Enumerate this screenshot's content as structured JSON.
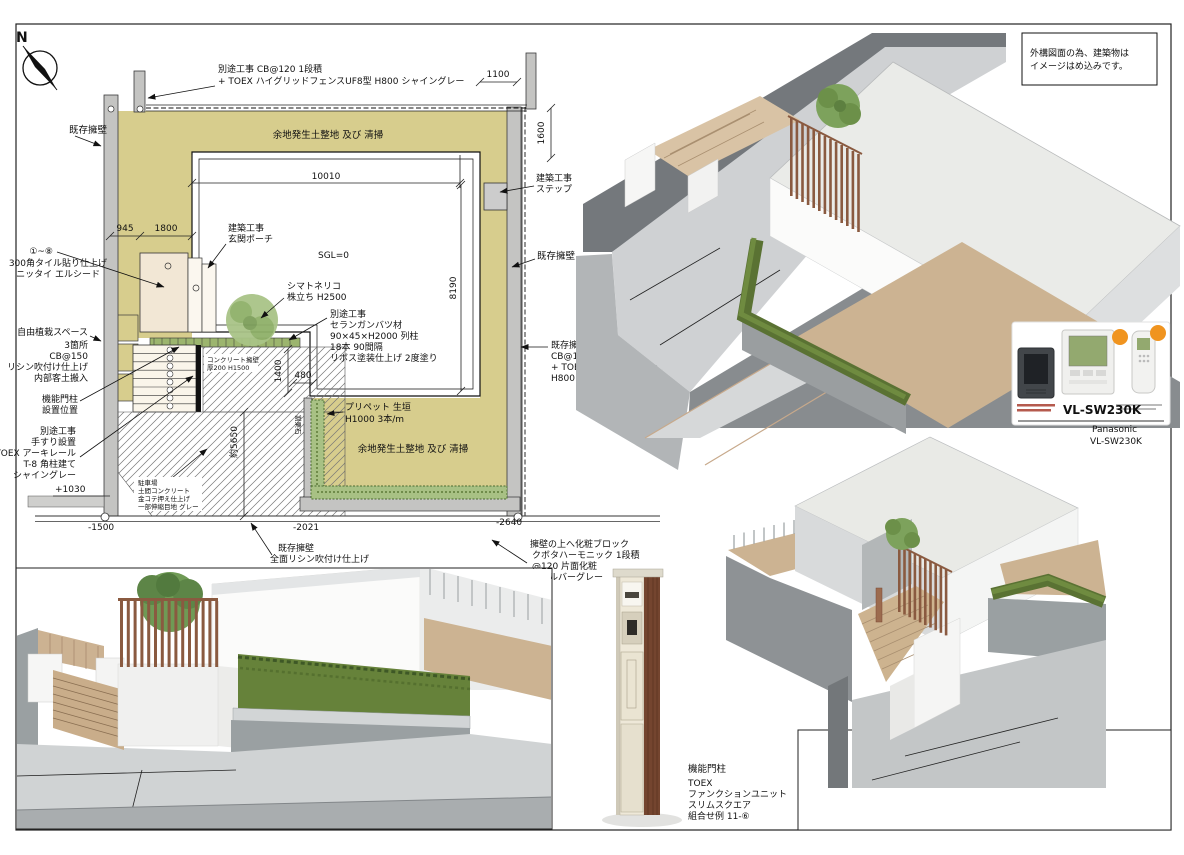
{
  "note": {
    "line1": "外構図面の為、建築物は",
    "line2": "イメージはめ込みです。"
  },
  "north_letter": "N",
  "plan": {
    "labels": {
      "wallLeft": "既存擁壁",
      "fenceTop1": "別途工事  CB@120 1段積",
      "fenceTop2": "+ TOEX ハイグリッドフェンスUF8型 H800 シャイングレー",
      "groundTop": "余地発生土整地 及び 清掃",
      "groundBottom": "余地発生土整地 及び 清掃",
      "step1": "建築工事",
      "step2": "ステップ",
      "porch1": "建築工事",
      "porch2": "玄関ポーチ",
      "tile1": "①~⑧",
      "tile2": "300角タイル貼り仕上げ",
      "tile3": "ニッタイ エルシード",
      "tree1": "シマトネリコ",
      "tree2": "株立ち H2500",
      "col1": "別途工事",
      "col2": "セランガンバツ材",
      "col3": "90×45×H2000 列柱",
      "col4": "18本 90間隔",
      "col5": "リボス塗装仕上げ 2度塗り",
      "wallRight": "既存擁壁",
      "wallTopR1": "既存擁壁の上に",
      "wallTopR2": "CB@100 1段積",
      "wallTopR3": "+ TOEX ハイグリッドフェンスUF8型",
      "wallTopR4": "H800 シャイングレー",
      "plant1": "自由植栽スペース",
      "plant2": "3箇所",
      "plant3": "CB@150",
      "plant4": "リシン吹付け仕上げ",
      "plant5": "内部客土搬入",
      "gatePos1": "機能門柱",
      "gatePos2": "設置位置",
      "rail1": "別途工事",
      "rail2": "手すり設置",
      "rail3": "TOEX アーキレール",
      "rail4": "T-8 角柱建て",
      "rail5": "シャイングレー",
      "privet1": "プリペット 生垣",
      "privet2": "H1000 3本/m",
      "wallBottom1": "既存擁壁",
      "wallBottom2": "全面リシン吹付け仕上げ",
      "deco1": "擁壁の上へ化粧ブロック",
      "deco2": "クボタハーモニック 1段積",
      "deco3": "@120 片面化粧",
      "deco4": "色:シルバーグレー",
      "concWall1": "コンクリート擁壁",
      "concWall2": "厚200 H1500",
      "parking1": "駐車場",
      "parking2": "土間コンクリート",
      "parking3": "金コテ押え仕上げ",
      "parking4": "一部伸縮目地 グレー",
      "rubble": "割栗石"
    },
    "dims": {
      "w10010": "10010",
      "h8190": "8190",
      "w1100": "1100",
      "h1600": "1600",
      "w945": "945",
      "w1800": "1800",
      "h1400": "1400",
      "w480": "480",
      "h5650": "約5650",
      "sgl": "SGL=0",
      "lvPlus1030": "+1030",
      "lvMinus1500": "-1500",
      "lvMinus2021": "-2021",
      "lvMinus2640": "-2640"
    }
  },
  "product": {
    "model": "VL-SW230K",
    "captionBrand": "Panasonic",
    "captionModel": "VL-SW230K"
  },
  "gatepost": {
    "l1": "機能門柱",
    "l2": "TOEX",
    "l3": "ファンクションユニット",
    "l4": "スリムスクエア",
    "l5": "組合せ例 11-⑥"
  },
  "colors": {
    "ground_olive": "#d7cd8d",
    "hedge_green": "#a8c184",
    "wood_brown": "#8a5a40",
    "badge_orange": "#f0941f"
  }
}
